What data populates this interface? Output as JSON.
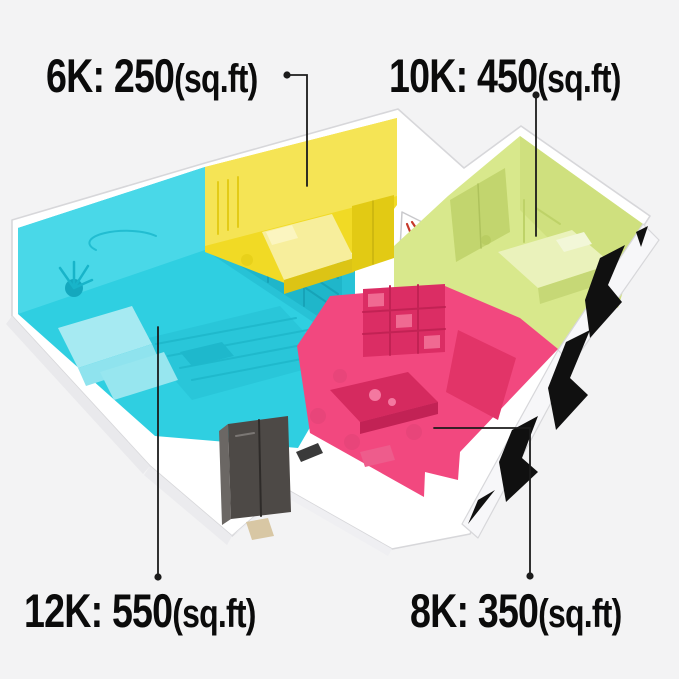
{
  "title": "Air conditioner BTU coverage floor plan",
  "units_label": "(sq.ft)",
  "annotations": [
    {
      "id": "6k",
      "text": "6K: 250",
      "unit": "(sq.ft)",
      "capacity": "6K",
      "area_sqft": 250,
      "target_room": "small-bedroom"
    },
    {
      "id": "10k",
      "text": "10K: 450",
      "unit": "(sq.ft)",
      "capacity": "10K",
      "area_sqft": 450,
      "target_room": "master-bedroom"
    },
    {
      "id": "12k",
      "text": "12K: 550",
      "unit": "(sq.ft)",
      "capacity": "12K",
      "area_sqft": 550,
      "target_room": "living-room"
    },
    {
      "id": "8k",
      "text": "8K: 350",
      "unit": "(sq.ft)",
      "capacity": "8K",
      "area_sqft": 350,
      "target_room": "kitchen-dining"
    }
  ],
  "rooms": [
    {
      "name": "living-room",
      "highlight_color": "#2FCFE1",
      "capacity": "12K",
      "area_sqft": 550
    },
    {
      "name": "small-bedroom",
      "highlight_color": "#F1DA25",
      "capacity": "6K",
      "area_sqft": 250
    },
    {
      "name": "master-bedroom",
      "highlight_color": "#D8E88C",
      "capacity": "10K",
      "area_sqft": 450
    },
    {
      "name": "kitchen-dining",
      "highlight_color": "#F2487F",
      "capacity": "8K",
      "area_sqft": 350
    }
  ],
  "colors": {
    "background": "#f3f3f4",
    "cyan": "#2FCFE1",
    "yellow": "#F1DA25",
    "green": "#D8E88C",
    "pink": "#F2487F",
    "walls_white": "#ffffff",
    "wall_edge": "#d7d7da",
    "window_black": "#101010",
    "wardrobe_dark": "#4d4946",
    "leader_line": "#1b1b1b",
    "label_text": "#0b0b0b"
  }
}
